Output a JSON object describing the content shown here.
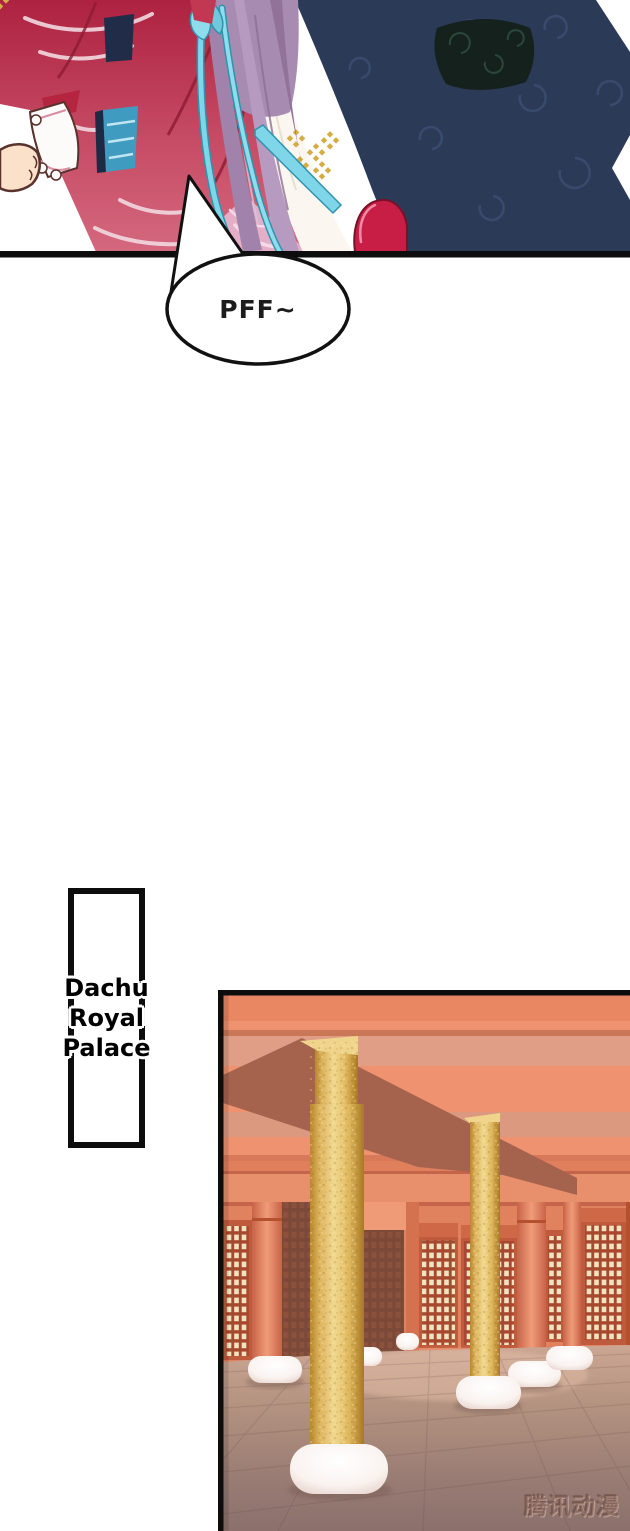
{
  "page": {
    "width": 630,
    "height": 1531,
    "background": "#ffffff"
  },
  "panel_top": {
    "label": "embrace-scene",
    "colors": {
      "dress_red": "#b02440",
      "dress_rose": "#d4687e",
      "robe_navy": "#2b3a57",
      "robe_swirl": "#41547a",
      "sash_dark": "#15211c",
      "hair_mauve": "#a78bb0",
      "ribbon_cyan": "#7fd6e8",
      "ribbon_edge": "#2f93ad",
      "skin": "#fbe0ca",
      "cuff_white": "#fdfbfa",
      "shoe_red": "#c81e46",
      "gold_diamond": "#d4ae45",
      "border_black": "#0d0d0d"
    }
  },
  "speech_bubble": {
    "text": "PFF~"
  },
  "location_label": {
    "text": "Dachu Royal Palace",
    "lines": [
      "Dachu",
      "Royal",
      "Palace"
    ]
  },
  "panel_palace": {
    "label": "palace-hall-scene",
    "watermark": "腾讯动漫",
    "colors": {
      "ceiling_salmon": "#ee926f",
      "beam_shadow": "#a5634e",
      "haze_pink": "#d9a18c",
      "wall_salmon": "#e1825f",
      "pilaster_light": "#f09c78",
      "panel_shadow_brown": "#7c4938",
      "lattice_frame": "#c05a3c",
      "lattice_cell": "#f2e3c0",
      "pillar_gold": "#e9c772",
      "pillar_gold_dark": "#b07c2a",
      "floor_mauve": "#9a7d74",
      "floor_light": "#cba693",
      "cushion_white": "#ffffff",
      "border_black": "#0d0d0d"
    }
  }
}
